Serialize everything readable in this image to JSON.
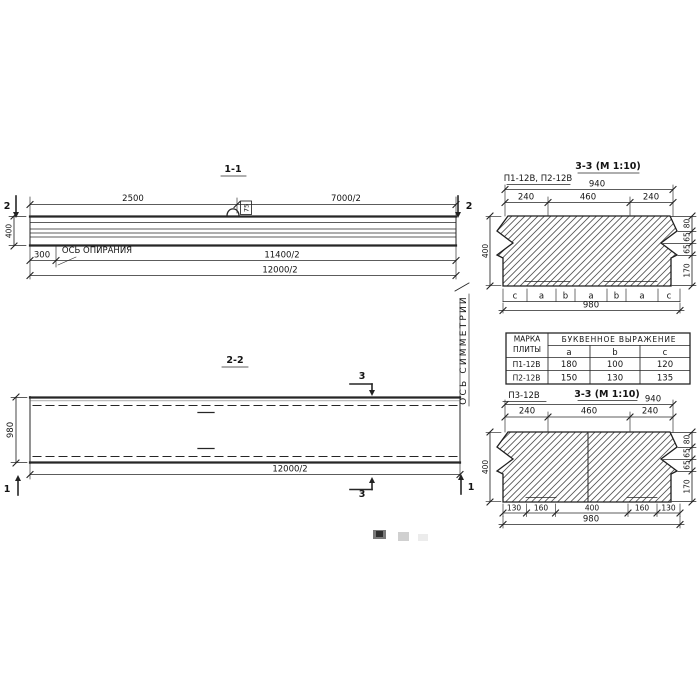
{
  "meta": {
    "paper": "#ffffff",
    "ink": "#222222"
  },
  "s11": {
    "title": "1-1",
    "cut_label": "2",
    "dim_top_left": "2500",
    "dim_top_right": "7000/2",
    "dim_height": "400",
    "dim_support_offset": "300",
    "dim_span_support": "11400/2",
    "dim_span_total": "12000/2",
    "support_axis": "ОСЬ ОПИРАНИЯ",
    "loop_mark": "75"
  },
  "s22": {
    "title": "2-2",
    "cut_label_3": "3",
    "cut_label_1": "1",
    "dim_width": "980",
    "dim_span": "12000/2",
    "symmetry_axis": "ОСЬ СИММЕТРИИ"
  },
  "cs1": {
    "label": "П1-12В, П2-12В",
    "title": "3-3 (М 1:10)",
    "dim_top_total": "940",
    "top_segments": [
      "240",
      "460",
      "240"
    ],
    "dim_height": "400",
    "right_segments": [
      "80",
      "65",
      "65",
      "170"
    ],
    "bottom_letters": [
      "c",
      "a",
      "b",
      "a",
      "b",
      "a",
      "c"
    ],
    "dim_bottom_total": "980"
  },
  "tbl": {
    "header_col1_line1": "МАРКА",
    "header_col1_line2": "ПЛИТЫ",
    "header_span": "БУКВЕННОЕ ВЫРАЖЕНИЕ",
    "columns": [
      "a",
      "b",
      "c"
    ],
    "rows": [
      [
        "П1-12В",
        "180",
        "100",
        "120"
      ],
      [
        "П2-12В",
        "150",
        "130",
        "135"
      ]
    ]
  },
  "cs3": {
    "label": "П3-12В",
    "title": "3-3 (М 1:10)",
    "dim_top_total": "940",
    "top_segments": [
      "240",
      "460",
      "240"
    ],
    "dim_height": "400",
    "right_segments": [
      "80",
      "65",
      "65",
      "170"
    ],
    "bottom_segments": [
      "130",
      "160",
      "400",
      "160",
      "130"
    ],
    "dim_bottom_total": "980"
  }
}
